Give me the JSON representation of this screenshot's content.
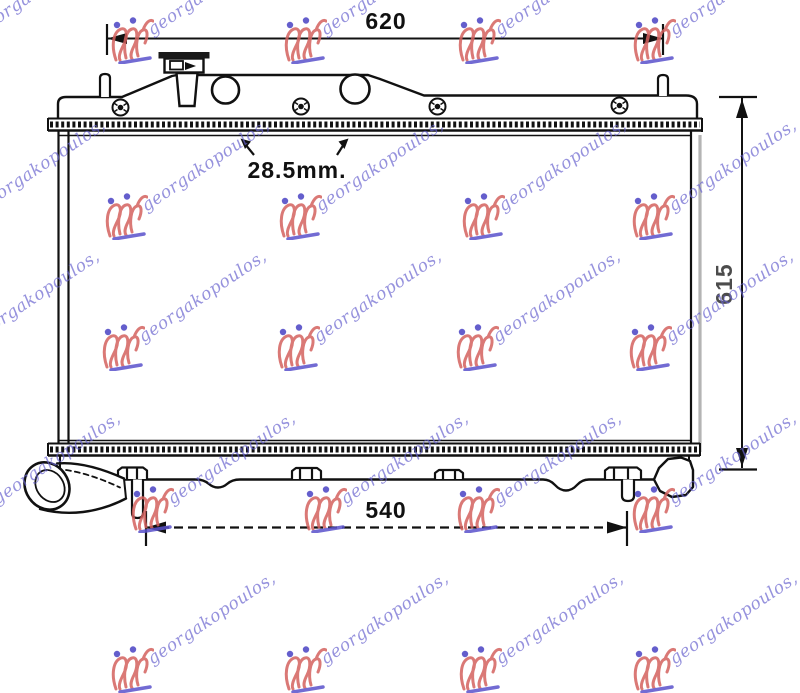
{
  "dimensions": {
    "top_width": "620",
    "bottom_width": "540",
    "height": "615",
    "pipe_diameter": "28.5mm."
  },
  "watermark": {
    "text": "georgakopoulos,"
  },
  "colors": {
    "line": "#111111",
    "core_side_gray": "#b4b4b4",
    "watermark_text": "#6863ce",
    "watermark_logo_red": "#d4625f",
    "watermark_logo_blue": "#5a52cc"
  }
}
